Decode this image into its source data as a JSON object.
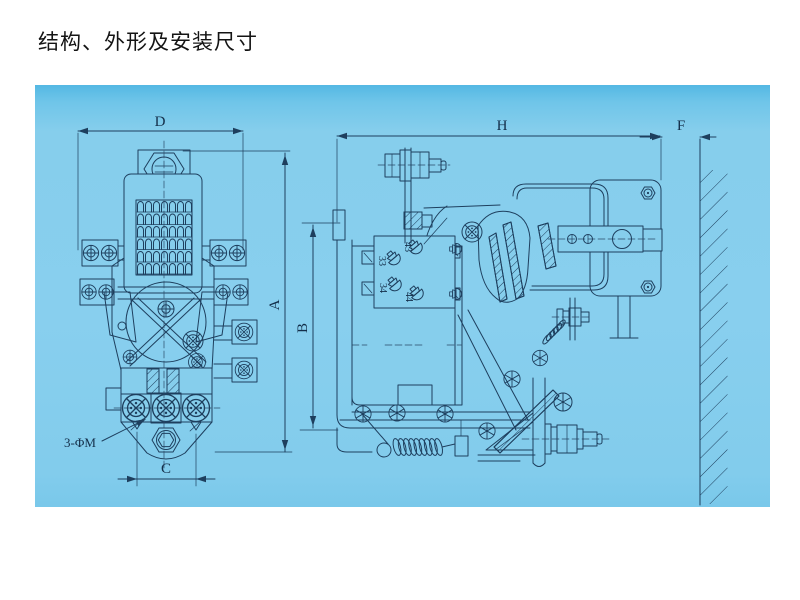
{
  "page": {
    "title": "结构、外形及安装尺寸"
  },
  "drawing": {
    "background_color": "#86ceec",
    "line_color": "#1e3f5e",
    "front_view": {
      "dim_width_top": "D",
      "dim_height_right": "A",
      "dim_bottom": "C",
      "mounting_holes_note": "3-ΦM"
    },
    "side_view": {
      "dim_width_top": "H",
      "dim_gap_right": "F",
      "dim_height_left": "B",
      "terminals": [
        "43",
        "33",
        "34",
        "44"
      ]
    }
  }
}
